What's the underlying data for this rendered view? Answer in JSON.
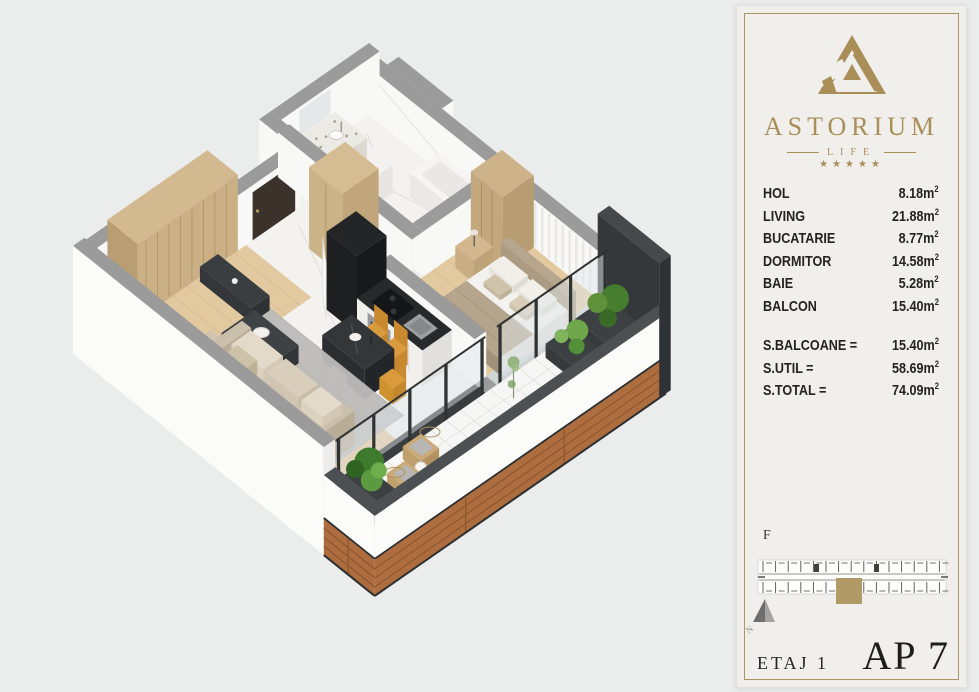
{
  "page_bg": "#ebecec",
  "plan_colors": {
    "wall_cap": "#9b9b9b",
    "wall_face": "#f8f8f7",
    "dark_cap": "#46494c",
    "dark_face": "#34383b",
    "dark_side": "#2e3235",
    "marble_floor": "#f3f2ef",
    "wood_floor": "#e3c9a0",
    "wood_line": "#d6bb92",
    "tile_floor": "#f6f6f4",
    "tile_line": "#e0dfdb",
    "rug": "#bdbcba",
    "entry_arrow_gold": "#ab8d55",
    "door_dark": "#3b322c",
    "glass": "#dfe7ea",
    "frame_dark": "#2f3334",
    "kitchen_black": "#232527",
    "sofa_beige": "#d3c8b4",
    "chair_mustard": "#d99b3d",
    "plant_green": "#477d2e",
    "plant_green_light": "#6fa84b",
    "facade_wood": "#ad6d3e",
    "facade_wood_dark": "#8a552d",
    "facade_white": "#fbfbfa"
  },
  "panel": {
    "bg": "#f1efec",
    "border_gold": "#ab9465",
    "brand": {
      "name": "ASTORIUM",
      "subtitle": "LIFE",
      "stars": "★★★★★",
      "gold": "#a98e58"
    },
    "rooms": [
      {
        "label": "HOL",
        "value": "8.18"
      },
      {
        "label": "LIVING",
        "value": "21.88"
      },
      {
        "label": "BUCATARIE",
        "value": "8.77"
      },
      {
        "label": "DORMITOR",
        "value": "14.58"
      },
      {
        "label": "BAIE",
        "value": "5.28"
      },
      {
        "label": "BALCON",
        "value": "15.40"
      }
    ],
    "totals": [
      {
        "label": "S.BALCOANE =",
        "value": "15.40"
      },
      {
        "label": "S.UTIL =",
        "value": "58.69"
      },
      {
        "label": "S.TOTAL =",
        "value": "74.09"
      }
    ],
    "unit": "m",
    "unit_sup": "2",
    "locator_label": "F",
    "north_letter": "N",
    "locator_gold": "#b29a66",
    "footer": {
      "floor": "ETAJ 1",
      "apartment": "AP 7"
    }
  }
}
